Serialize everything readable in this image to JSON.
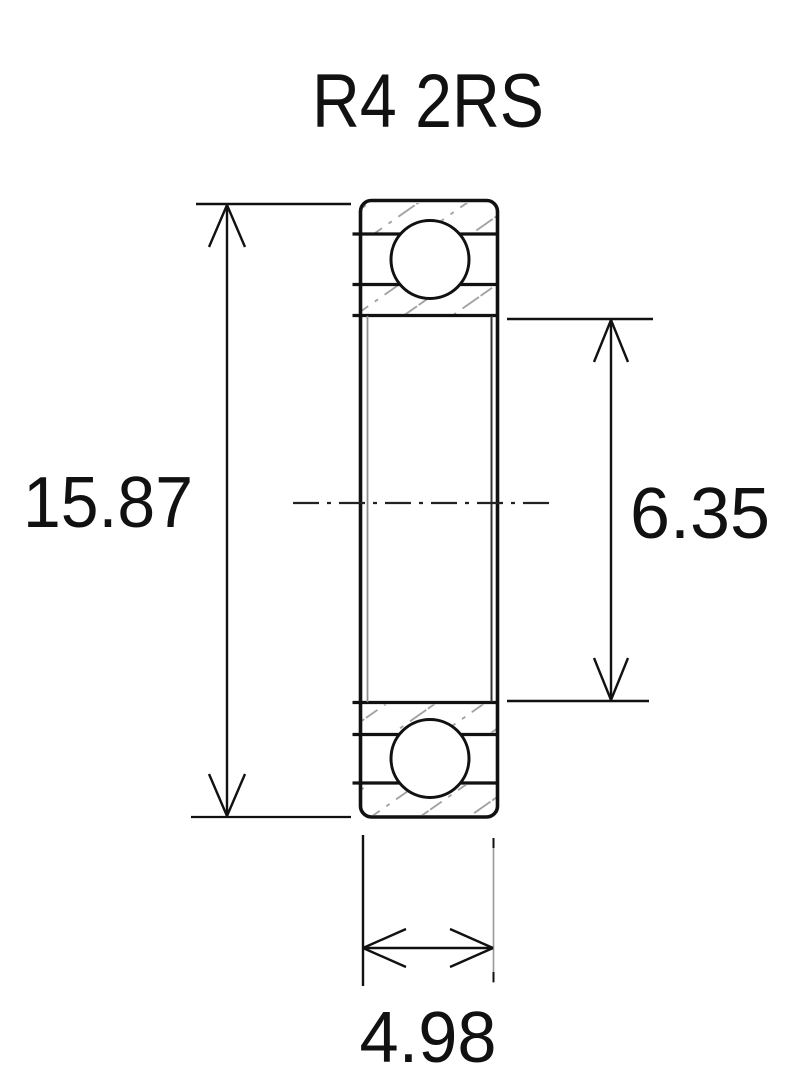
{
  "title": "R4 2RS",
  "dimensions": {
    "outer_diameter": "15.87",
    "inner_diameter": "6.35",
    "width": "4.98"
  },
  "colors": {
    "line": "#111111",
    "hatch": "#9c9c9c",
    "background": "#ffffff"
  }
}
